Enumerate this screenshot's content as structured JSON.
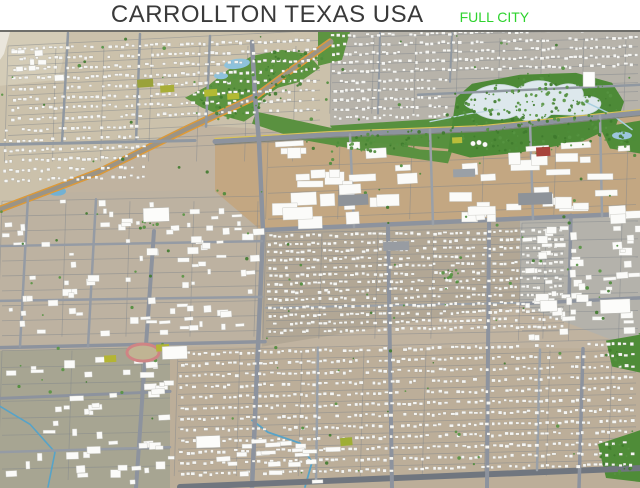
{
  "header": {
    "title": "CARROLLTON TEXAS USA",
    "badge": "FULL CITY",
    "title_color": "#3a3a3a",
    "badge_color": "#2ed32e",
    "background": "#ffffff"
  },
  "scene": {
    "base": "#c0b3a0",
    "house_fill": "#f6f6f3",
    "house_stroke": "rgba(118,118,112,0.5)",
    "big_fill": "#fbfbf9",
    "big_stroke": "#c3c3bd",
    "tree_colors": [
      "#4e8c3a",
      "#3f7a2e",
      "#579441"
    ],
    "grid_color": "rgba(128,133,140,0.5)",
    "patches": [
      {
        "n": "left-mid-ground",
        "pts": "0,192 262,188 262,346 0,350",
        "f": "#bdb2a1"
      },
      {
        "n": "top-left-residential",
        "pts": "0,30 330,30 330,131 200,124 100,170 0,208",
        "f": "#cbc1ab"
      },
      {
        "n": "top-right-residential",
        "pts": "330,30 640,30 640,109 455,120 330,131",
        "f": "#b7b3aa"
      },
      {
        "n": "industrial-band",
        "pts": "215,140 330,133 483,127 640,111 640,217 262,230 215,190",
        "f": "#c3a782"
      },
      {
        "n": "right-commercial",
        "pts": "520,217 640,211 640,350 520,304",
        "f": "#b4b2ab"
      },
      {
        "n": "mid-residential",
        "pts": "262,230 520,219 520,304 262,346",
        "f": "#b2a795"
      },
      {
        "n": "bottom-residential",
        "pts": "170,346 640,348 640,488 170,488",
        "f": "#bcae99"
      },
      {
        "n": "bottom-left-commercial",
        "pts": "0,350 170,346 170,488 0,488",
        "f": "#a7a592"
      },
      {
        "n": "top-left-open-corner",
        "pts": "0,30 70,30 58,78 0,84",
        "f": "#d4ccb7"
      }
    ],
    "grids": [
      {
        "x": 8,
        "y": 44,
        "w": 312,
        "h": 116,
        "sp": 10,
        "sl": -0.05,
        "vsp": 48
      },
      {
        "x": 332,
        "y": 36,
        "w": 306,
        "h": 76,
        "sp": 9,
        "sl": -0.03,
        "vsp": 42
      },
      {
        "x": 266,
        "y": 232,
        "w": 298,
        "h": 106,
        "sp": 8,
        "sl": -0.02,
        "vsp": 56
      },
      {
        "x": 178,
        "y": 350,
        "w": 458,
        "h": 126,
        "sp": 11,
        "sl": -0.025,
        "vsp": 62
      },
      {
        "x": 2,
        "y": 200,
        "w": 258,
        "h": 136,
        "sp": 15,
        "sl": -0.02,
        "vsp": 64
      },
      {
        "x": 2,
        "y": 350,
        "w": 168,
        "h": 130,
        "sp": 17,
        "sl": -0.02,
        "vsp": 70
      },
      {
        "x": 268,
        "y": 140,
        "w": 368,
        "h": 78,
        "sp": 26,
        "sl": -0.04,
        "vsp": 72
      },
      {
        "x": 522,
        "y": 222,
        "w": 116,
        "h": 118,
        "sp": 18,
        "sl": -0.02,
        "vsp": 50
      }
    ],
    "greens": [
      {
        "pts": "318,30 350,30 342,58 318,64",
        "f": "#5d9440"
      },
      {
        "pts": "185,96 208,84 228,68 252,54 282,48 308,52 320,66 300,80 278,86 263,96 256,112 244,120 222,114 202,106",
        "f": "#5d9440"
      },
      {
        "pts": "256,110 330,126 420,148 452,150 448,162 380,152 300,138 252,122",
        "f": "#5a9140"
      },
      {
        "pts": "330,124 455,116 455,148 340,138",
        "f": "#57903e"
      },
      {
        "pts": "448,150 456,96 472,82 520,73 576,71 612,81 624,100 616,124 582,140 520,151 470,156",
        "f": "#4d8a37"
      },
      {
        "pts": "600,126 640,119 640,152 610,147",
        "f": "#4f8c38"
      },
      {
        "pts": "606,340 640,334 640,372 612,366",
        "f": "#4f8c38"
      },
      {
        "pts": "598,444 640,430 640,482 606,478",
        "f": "#4f8c38"
      }
    ],
    "waters": [
      {
        "t": "path",
        "d": "M468,98 C476,84 500,78 518,87 C528,77 548,76 556,85 C570,78 586,84 583,95 C600,93 606,102 596,109 C584,117 564,112 551,113 C543,121 526,123 516,114 C498,122 480,116 473,108 C464,104 462,102 468,98 Z",
        "f": "#dde8ec",
        "s": "#c6d6da"
      },
      {
        "t": "ell",
        "x": 57,
        "y": 190,
        "rx": 9,
        "ry": 4.5,
        "f": "#72b1d3"
      },
      {
        "t": "ell",
        "x": 237,
        "y": 62,
        "rx": 13,
        "ry": 5,
        "f": "#8ec2dc",
        "rot": -8
      },
      {
        "t": "ell",
        "x": 221,
        "y": 74,
        "rx": 7,
        "ry": 3.5,
        "f": "#8ec2dc"
      },
      {
        "t": "ell",
        "x": 622,
        "y": 134,
        "rx": 10,
        "ry": 4,
        "f": "#9cc6de"
      },
      {
        "t": "line",
        "pts": "585,100 612,113 632,128",
        "c": "#a9cede",
        "w": 1.5
      },
      {
        "t": "line",
        "pts": "430,120 470,112 498,108",
        "c": "#bcd6de",
        "w": 1.2
      },
      {
        "t": "line",
        "pts": "305,487 312,462 300,443 268,432 252,420",
        "c": "#57a3c8",
        "w": 1.8
      },
      {
        "t": "line",
        "pts": "0,406 30,424 55,452 48,487",
        "c": "#57a3c8",
        "w": 1.6
      }
    ],
    "roads": [
      {
        "pts": "0,208 100,170 187,127 255,95 302,60 330,40",
        "w": 7,
        "c": "#9b9486"
      },
      {
        "pts": "0,205 100,167 187,124 255,92 302,57 330,37",
        "w": 1.4,
        "c": "#e09a35"
      },
      {
        "pts": "0,211 100,173 188,130 256,98 303,63 331,43",
        "w": 1.4,
        "c": "#e09a35"
      },
      {
        "pts": "215,140 330,133 483,127 640,111",
        "w": 5,
        "c": "#8d939e"
      },
      {
        "pts": "215,137 330,130 483,124 640,108",
        "w": 1.2,
        "c": "#d9c25a"
      },
      {
        "pts": "215,143 330,136 483,130 640,114",
        "w": 1,
        "c": "#7e8279"
      },
      {
        "pts": "252,40 255,95 259,140 263,230 258,346 252,488",
        "w": 4.5,
        "c": "#8d939e"
      },
      {
        "pts": "262,229 640,212",
        "w": 4.5,
        "c": "#8d939e"
      },
      {
        "pts": "520,303 640,297",
        "w": 3.5,
        "c": "#8d939e"
      },
      {
        "pts": "266,307 520,302",
        "w": 2,
        "c": "#99a0a8"
      },
      {
        "pts": "180,487 420,477 640,468",
        "w": 6,
        "c": "#70767f"
      },
      {
        "pts": "0,347 265,341",
        "w": 3.5,
        "c": "#8d939e"
      },
      {
        "pts": "0,245 262,240",
        "w": 2.5,
        "c": "#959ba4"
      },
      {
        "pts": "0,300 262,296",
        "w": 2.5,
        "c": "#959ba4"
      },
      {
        "pts": "0,143 195,139",
        "w": 3,
        "c": "#9098a1"
      },
      {
        "pts": "68,31 62,142",
        "w": 2.5,
        "c": "#9098a1"
      },
      {
        "pts": "140,32 136,140",
        "w": 2.5,
        "c": "#9098a1"
      },
      {
        "pts": "210,34 206,125",
        "w": 2.5,
        "c": "#9098a1"
      },
      {
        "pts": "380,31 378,112",
        "w": 2,
        "c": "#9098a1"
      },
      {
        "pts": "452,31 450,80",
        "w": 2,
        "c": "#9098a1"
      },
      {
        "pts": "418,93 640,83",
        "w": 2.5,
        "c": "#9098a1"
      },
      {
        "pts": "388,226 392,488",
        "w": 4,
        "c": "#8d939e"
      },
      {
        "pts": "489,220 487,488",
        "w": 4,
        "c": "#8d939e"
      },
      {
        "pts": "571,214 569,302",
        "w": 3.5,
        "c": "#8d939e"
      },
      {
        "pts": "583,348 579,488",
        "w": 3.5,
        "c": "#8d939e"
      },
      {
        "pts": "154,230 136,488",
        "w": 4,
        "c": "#8d939e"
      },
      {
        "pts": "28,196 20,346",
        "w": 2.5,
        "c": "#959ba4"
      },
      {
        "pts": "96,198 88,346",
        "w": 2.5,
        "c": "#959ba4"
      },
      {
        "pts": "350,133 354,226",
        "w": 2.5,
        "c": "#9aa0a8"
      },
      {
        "pts": "430,128 433,223",
        "w": 2.5,
        "c": "#9aa0a8"
      },
      {
        "pts": "530,120 533,218",
        "w": 2.5,
        "c": "#9aa0a8"
      },
      {
        "pts": "600,114 602,215",
        "w": 2.5,
        "c": "#9aa0a8"
      },
      {
        "pts": "318,347 316,482",
        "w": 2.5,
        "c": "#99a0a8"
      },
      {
        "pts": "540,349 537,470",
        "w": 2.5,
        "c": "#99a0a8"
      },
      {
        "pts": "0,398 170,391",
        "w": 3,
        "c": "#8d939e"
      },
      {
        "pts": "0,452 170,447",
        "w": 2.5,
        "c": "#959ba4"
      }
    ],
    "rows": [
      {
        "x": 12,
        "y": 46,
        "w": 304,
        "h": 78,
        "rs": 10,
        "dx": 6,
        "sl": -0.03
      },
      {
        "x": 4,
        "y": 128,
        "w": 140,
        "h": 56,
        "rs": 10,
        "dx": 6,
        "sl": -0.03
      },
      {
        "x": 332,
        "y": 33,
        "w": 304,
        "h": 44,
        "rs": 9,
        "dx": 5.5,
        "sl": -0.025
      },
      {
        "x": 334,
        "y": 79,
        "w": 114,
        "h": 40,
        "rs": 9,
        "dx": 5.5,
        "sl": -0.025
      },
      {
        "x": 268,
        "y": 234,
        "w": 294,
        "h": 102,
        "rs": 8,
        "dx": 5.5,
        "sl": -0.02
      },
      {
        "x": 180,
        "y": 352,
        "w": 454,
        "h": 124,
        "rs": 11,
        "dx": 6,
        "sl": -0.022
      }
    ],
    "scatters": [
      {
        "x": 2,
        "y": 198,
        "w": 254,
        "h": 138,
        "n": 90,
        "w1": 3,
        "w2": 12,
        "h1": 2.5,
        "h2": 7
      },
      {
        "x": 268,
        "y": 140,
        "w": 365,
        "h": 78,
        "n": 55,
        "w1": 8,
        "w2": 30,
        "h1": 5,
        "h2": 13
      },
      {
        "x": 522,
        "y": 222,
        "w": 114,
        "h": 118,
        "n": 55,
        "w1": 4,
        "w2": 14,
        "h1": 3,
        "h2": 8
      },
      {
        "x": 2,
        "y": 350,
        "w": 166,
        "h": 130,
        "n": 50,
        "w1": 4,
        "w2": 14,
        "h1": 3,
        "h2": 8
      },
      {
        "x": 205,
        "y": 438,
        "w": 124,
        "h": 46,
        "n": 20,
        "w1": 8,
        "w2": 16,
        "h1": 3.5,
        "h2": 5
      },
      {
        "x": 4,
        "y": 33,
        "w": 60,
        "h": 44,
        "n": 8,
        "w1": 4,
        "w2": 10,
        "h1": 3,
        "h2": 6
      }
    ],
    "tree_blobs": [
      {
        "x": 258,
        "y": 82,
        "rx": 72,
        "ry": 24,
        "rot": -25,
        "n": 90
      },
      {
        "x": 533,
        "y": 113,
        "rx": 88,
        "ry": 40,
        "rot": -4,
        "n": 240
      },
      {
        "x": 385,
        "y": 140,
        "rx": 62,
        "ry": 10,
        "rot": -7,
        "n": 50
      },
      {
        "x": 622,
        "y": 137,
        "rx": 17,
        "ry": 10,
        "rot": 0,
        "n": 18
      },
      {
        "x": 622,
        "y": 353,
        "rx": 17,
        "ry": 13,
        "rot": 0,
        "n": 16
      },
      {
        "x": 620,
        "y": 458,
        "rx": 20,
        "ry": 16,
        "rot": 0,
        "n": 18
      },
      {
        "x": 452,
        "y": 275,
        "rx": 10,
        "ry": 8,
        "rot": 0,
        "n": 12
      },
      {
        "x": 150,
        "y": 223,
        "rx": 8,
        "ry": 5,
        "rot": 0,
        "n": 8
      }
    ],
    "sprinkle_trees": 150,
    "landmarks": [
      {
        "t": "ring",
        "n": "running-track",
        "x": 143,
        "y": 352,
        "rx": 16,
        "ry": 8.5,
        "c": "#cf8484",
        "w": 3,
        "f": "#c0b493"
      },
      {
        "t": "rect",
        "n": "sports-field",
        "x": 156,
        "y": 344,
        "w": 13,
        "h": 7,
        "f": "#b4b534",
        "rot": -3
      },
      {
        "t": "rect",
        "n": "sports-field",
        "x": 104,
        "y": 355,
        "w": 12,
        "h": 7,
        "f": "#b4b534",
        "rot": -3
      },
      {
        "t": "rect",
        "n": "sports-field",
        "x": 137,
        "y": 78,
        "w": 16,
        "h": 8,
        "f": "#9aa23a",
        "rot": -4
      },
      {
        "t": "rect",
        "n": "sports-field",
        "x": 160,
        "y": 84,
        "w": 14,
        "h": 7,
        "f": "#a8ae38",
        "rot": -4
      },
      {
        "t": "rect",
        "n": "sports-field",
        "x": 204,
        "y": 88,
        "w": 13,
        "h": 7,
        "f": "#b2ba33",
        "rot": -4
      },
      {
        "t": "rect",
        "n": "sports-field",
        "x": 227,
        "y": 92,
        "w": 12,
        "h": 6,
        "f": "#b2ba33",
        "rot": -4
      },
      {
        "t": "rect",
        "n": "sports-field",
        "x": 452,
        "y": 136,
        "w": 10,
        "h": 6,
        "f": "#b9bd3a",
        "rot": -3
      },
      {
        "t": "rect",
        "n": "sports-field",
        "x": 340,
        "y": 438,
        "w": 12,
        "h": 8,
        "f": "#9fae35",
        "rot": -5
      },
      {
        "t": "rect",
        "n": "red-roof-building",
        "x": 536,
        "y": 146,
        "w": 14,
        "h": 9,
        "f": "#a8433b",
        "rot": -3
      },
      {
        "t": "rect",
        "n": "parking-lot",
        "x": 338,
        "y": 194,
        "w": 30,
        "h": 11,
        "f": "#8e9399",
        "rot": -3
      },
      {
        "t": "rect",
        "n": "parking-lot",
        "x": 518,
        "y": 192,
        "w": 34,
        "h": 12,
        "f": "#8e9399",
        "rot": -2
      },
      {
        "t": "rect",
        "n": "parking-lot",
        "x": 383,
        "y": 241,
        "w": 26,
        "h": 9,
        "f": "#989ca2",
        "rot": -2
      },
      {
        "t": "rect",
        "n": "parking-lot",
        "x": 453,
        "y": 168,
        "w": 22,
        "h": 8,
        "f": "#9aa0a6",
        "rot": -2
      },
      {
        "t": "rect",
        "n": "large-building",
        "x": 143,
        "y": 207,
        "w": 26,
        "h": 14,
        "f": "#fcfcfa",
        "s": "#b9b9b3",
        "rot": -2
      },
      {
        "t": "rect",
        "n": "school-building",
        "x": 162,
        "y": 346,
        "w": 25,
        "h": 13,
        "f": "#fcfcfa",
        "s": "#b9b9b3",
        "rot": -2
      },
      {
        "t": "rect",
        "n": "tower-building",
        "x": 583,
        "y": 70,
        "w": 12,
        "h": 15,
        "f": "#fdfdfc",
        "s": "#b9b9b3",
        "rot": 0
      },
      {
        "t": "rect",
        "n": "large-building",
        "x": 540,
        "y": 300,
        "w": 17,
        "h": 11,
        "f": "#fcfcfa",
        "s": "#b9b9b3",
        "rot": -2
      },
      {
        "t": "rect",
        "n": "large-building",
        "x": 600,
        "y": 299,
        "w": 30,
        "h": 14,
        "f": "#fcfcfa",
        "s": "#b9b9b3",
        "rot": -2
      },
      {
        "t": "rect",
        "n": "large-building",
        "x": 196,
        "y": 436,
        "w": 24,
        "h": 12,
        "f": "#fcfcfa",
        "s": "#b9b9b3",
        "rot": -2
      },
      {
        "t": "circ",
        "n": "storage-tank",
        "x": 473,
        "y": 142,
        "r": 2.4,
        "f": "#fbfbfa",
        "s": "#c0c0ba"
      },
      {
        "t": "circ",
        "n": "storage-tank",
        "x": 479,
        "y": 141,
        "r": 2.4,
        "f": "#fbfbfa",
        "s": "#c0c0ba"
      },
      {
        "t": "circ",
        "n": "storage-tank",
        "x": 485,
        "y": 143,
        "r": 2.4,
        "f": "#fbfbfa",
        "s": "#c0c0ba"
      },
      {
        "t": "poly",
        "n": "edge-sliver",
        "pts": "0,30 10,30 4,52 0,58",
        "f": "#eae6dc"
      }
    ]
  }
}
